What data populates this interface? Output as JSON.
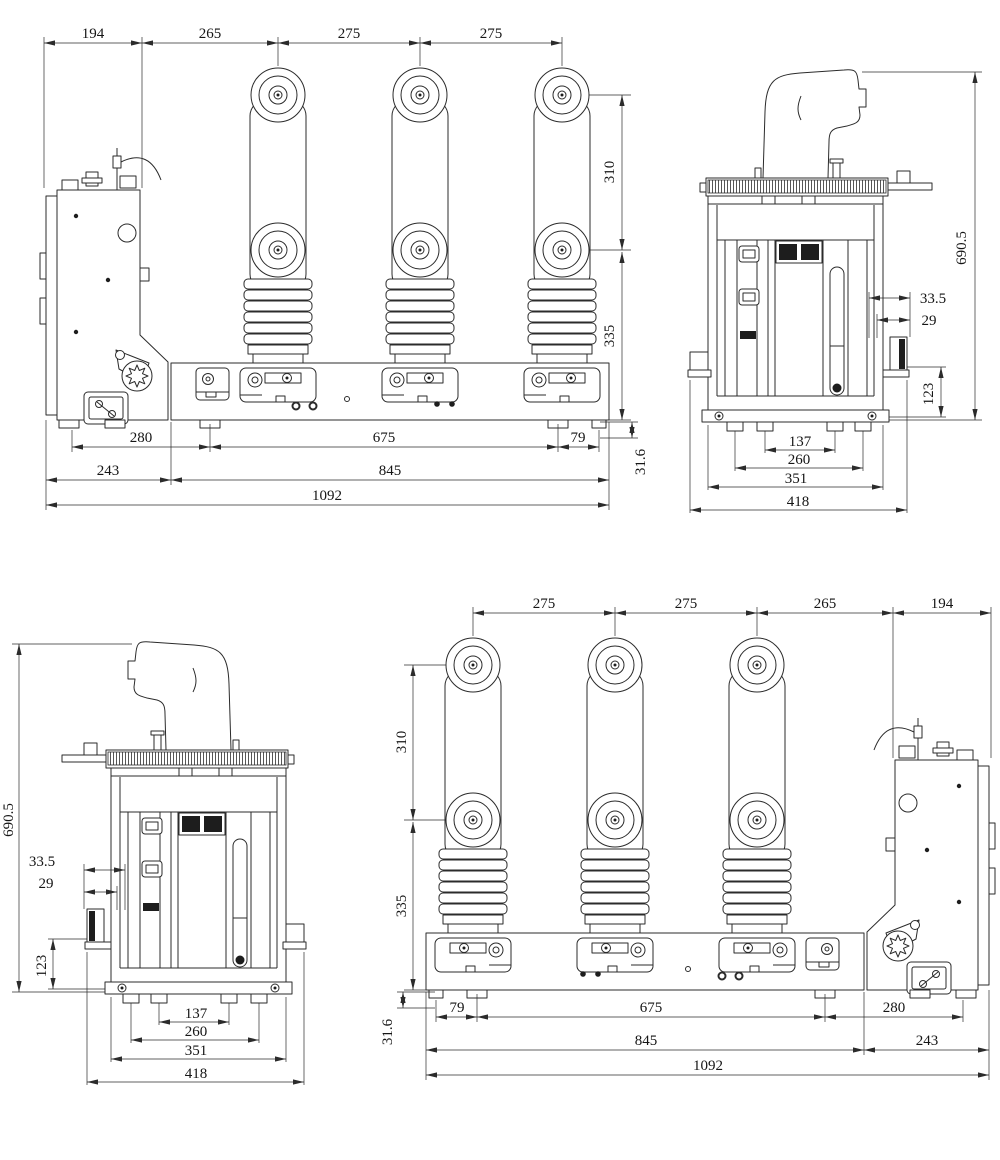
{
  "colors": {
    "background": "#ffffff",
    "line": "#2b2b2b"
  },
  "views": {
    "front_top": {
      "top_dims": [
        "194",
        "265",
        "275",
        "275"
      ],
      "side_dims": [
        "310",
        "335"
      ],
      "bottom_row1": [
        "280",
        "675",
        "79"
      ],
      "bottom_row2": [
        "243",
        "845"
      ],
      "bottom_row3": [
        "1092"
      ],
      "edge_dim": "31.6"
    },
    "side_right": {
      "height_dim": "690.5",
      "offset_dims": [
        "33.5",
        "29"
      ],
      "bracket_dim": "123",
      "bottom_dims": [
        "137",
        "260",
        "351",
        "418"
      ]
    },
    "side_left": {
      "height_dim": "690.5",
      "offset_dims": [
        "33.5",
        "29"
      ],
      "bracket_dim": "123",
      "bottom_dims": [
        "137",
        "260",
        "351",
        "418"
      ]
    },
    "front_bottom": {
      "top_dims": [
        "275",
        "275",
        "265",
        "194"
      ],
      "side_dims": [
        "310",
        "335"
      ],
      "bottom_row1": [
        "79",
        "675",
        "280"
      ],
      "bottom_row2": [
        "845",
        "243"
      ],
      "bottom_row3": [
        "1092"
      ],
      "edge_dim": "31.6"
    }
  }
}
